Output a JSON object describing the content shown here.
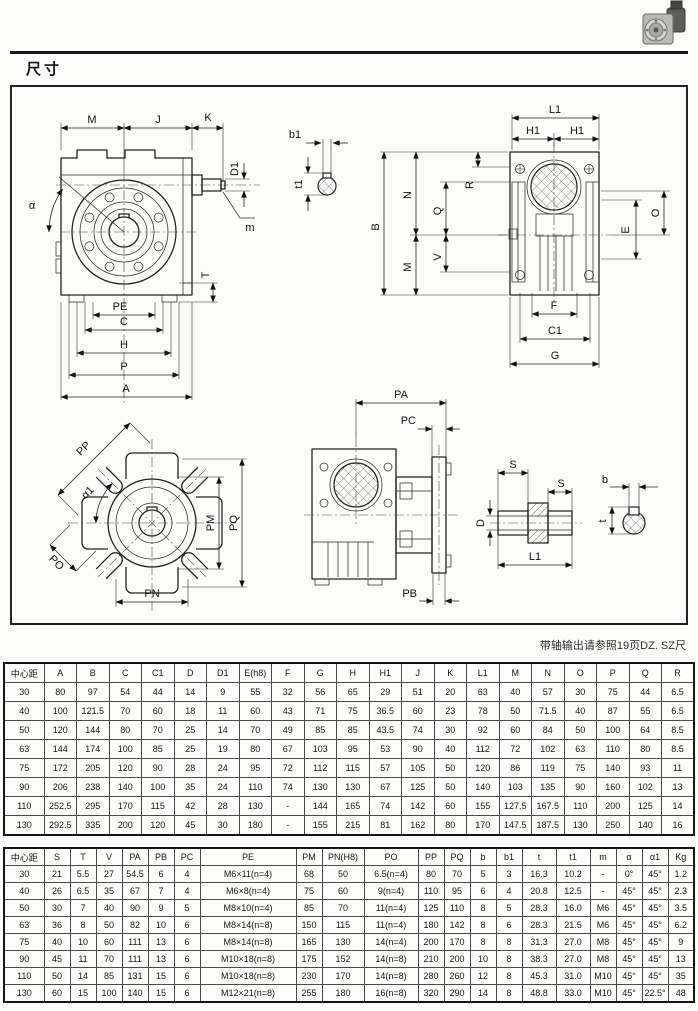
{
  "page": {
    "title": "尺寸",
    "note": "带轴输出请参照19页DZ. SZ尺"
  },
  "labels": {
    "front": {
      "M": "M",
      "J": "J",
      "K": "K",
      "D1": "D1",
      "m": "m",
      "alpha": "α",
      "T": "T",
      "PE": "PE",
      "C": "C",
      "H": "H",
      "P": "P",
      "A": "A",
      "b1": "b1",
      "t1": "t1"
    },
    "side": {
      "L1": "L1",
      "H1_left": "H1",
      "H1_right": "H1",
      "B": "B",
      "N": "N",
      "Q": "Q",
      "R": "R",
      "M": "M",
      "V": "V",
      "O": "O",
      "E": "E",
      "F": "F",
      "C1": "C1",
      "G": "G"
    },
    "flange": {
      "PP": "PP",
      "alpha1": "α1",
      "PM": "PM",
      "PQ": "PQ",
      "PO": "PO",
      "PN": "PN"
    },
    "mount": {
      "PA": "PA",
      "PC": "PC",
      "PB": "PB"
    },
    "shaft": {
      "S_left": "S",
      "S_right": "S",
      "D": "D",
      "L1": "L1",
      "b": "b",
      "t": "t"
    }
  },
  "table1": {
    "headers": [
      "中心距",
      "A",
      "B",
      "C",
      "C1",
      "D",
      "D1",
      "E(h8)",
      "F",
      "G",
      "H",
      "H1",
      "J",
      "K",
      "L1",
      "M",
      "N",
      "O",
      "P",
      "Q",
      "R"
    ],
    "rows": [
      [
        "30",
        "80",
        "97",
        "54",
        "44",
        "14",
        "9",
        "55",
        "32",
        "56",
        "65",
        "29",
        "51",
        "20",
        "63",
        "40",
        "57",
        "30",
        "75",
        "44",
        "6.5"
      ],
      [
        "40",
        "100",
        "121.5",
        "70",
        "60",
        "18",
        "11",
        "60",
        "43",
        "71",
        "75",
        "36.5",
        "60",
        "23",
        "78",
        "50",
        "71.5",
        "40",
        "87",
        "55",
        "6.5"
      ],
      [
        "50",
        "120",
        "144",
        "80",
        "70",
        "25",
        "14",
        "70",
        "49",
        "85",
        "85",
        "43.5",
        "74",
        "30",
        "92",
        "60",
        "84",
        "50",
        "100",
        "64",
        "8.5"
      ],
      [
        "63",
        "144",
        "174",
        "100",
        "85",
        "25",
        "19",
        "80",
        "67",
        "103",
        "95",
        "53",
        "90",
        "40",
        "112",
        "72",
        "102",
        "63",
        "110",
        "80",
        "8.5"
      ],
      [
        "75",
        "172",
        "205",
        "120",
        "90",
        "28",
        "24",
        "95",
        "72",
        "112",
        "115",
        "57",
        "105",
        "50",
        "120",
        "86",
        "119",
        "75",
        "140",
        "93",
        "11"
      ],
      [
        "90",
        "206",
        "238",
        "140",
        "100",
        "35",
        "24",
        "110",
        "74",
        "130",
        "130",
        "67",
        "125",
        "50",
        "140",
        "103",
        "135",
        "90",
        "160",
        "102",
        "13"
      ],
      [
        "110",
        "252.5",
        "295",
        "170",
        "115",
        "42",
        "28",
        "130",
        "-",
        "144",
        "165",
        "74",
        "142",
        "60",
        "155",
        "127.5",
        "167.5",
        "110",
        "200",
        "125",
        "14"
      ],
      [
        "130",
        "292.5",
        "335",
        "200",
        "120",
        "45",
        "30",
        "180",
        "-",
        "155",
        "215",
        "81",
        "162",
        "80",
        "170",
        "147.5",
        "187.5",
        "130",
        "250",
        "140",
        "16"
      ]
    ]
  },
  "table2": {
    "headers": [
      "中心距",
      "S",
      "T",
      "V",
      "PA",
      "PB",
      "PC",
      "PE",
      "PM",
      "PN(H8)",
      "PO",
      "PP",
      "PQ",
      "b",
      "b1",
      "t",
      "t1",
      "m",
      "α",
      "α1",
      "Kg"
    ],
    "rows": [
      [
        "30",
        "21",
        "5.5",
        "27",
        "54.5",
        "6",
        "4",
        "M6×11(n=4)",
        "68",
        "50",
        "6.5(n=4)",
        "80",
        "70",
        "5",
        "3",
        "16.3",
        "10.2",
        "-",
        "0°",
        "45°",
        "1.2"
      ],
      [
        "40",
        "26",
        "6.5",
        "35",
        "67",
        "7",
        "4",
        "M6×8(n=4)",
        "75",
        "60",
        "9(n=4)",
        "110",
        "95",
        "6",
        "4",
        "20.8",
        "12.5",
        "-",
        "45°",
        "45°",
        "2.3"
      ],
      [
        "50",
        "30",
        "7",
        "40",
        "90",
        "9",
        "5",
        "M8×10(n=4)",
        "85",
        "70",
        "11(n=4)",
        "125",
        "110",
        "8",
        "5",
        "28.3",
        "16.0",
        "M6",
        "45°",
        "45°",
        "3.5"
      ],
      [
        "63",
        "36",
        "8",
        "50",
        "82",
        "10",
        "6",
        "M8×14(n=8)",
        "150",
        "115",
        "11(n=4)",
        "180",
        "142",
        "8",
        "6",
        "28.3",
        "21.5",
        "M6",
        "45°",
        "45°",
        "6.2"
      ],
      [
        "75",
        "40",
        "10",
        "60",
        "111",
        "13",
        "6",
        "M8×14(n=8)",
        "165",
        "130",
        "14(n=4)",
        "200",
        "170",
        "8",
        "8",
        "31.3",
        "27.0",
        "M8",
        "45°",
        "45°",
        "9"
      ],
      [
        "90",
        "45",
        "11",
        "70",
        "111",
        "13",
        "6",
        "M10×18(n=8)",
        "175",
        "152",
        "14(n=8)",
        "210",
        "200",
        "10",
        "8",
        "38.3",
        "27.0",
        "M8",
        "45°",
        "45°",
        "13"
      ],
      [
        "110",
        "50",
        "14",
        "85",
        "131",
        "15",
        "6",
        "M10×18(n=8)",
        "230",
        "170",
        "14(n=8)",
        "280",
        "260",
        "12",
        "8",
        "45.3",
        "31.0",
        "M10",
        "45°",
        "45°",
        "35"
      ],
      [
        "130",
        "60",
        "15",
        "100",
        "140",
        "15",
        "6",
        "M12×21(n=8)",
        "255",
        "180",
        "16(n=8)",
        "320",
        "290",
        "14",
        "8",
        "48.8",
        "33.0",
        "M10",
        "45°",
        "22.5°",
        "48"
      ]
    ]
  }
}
